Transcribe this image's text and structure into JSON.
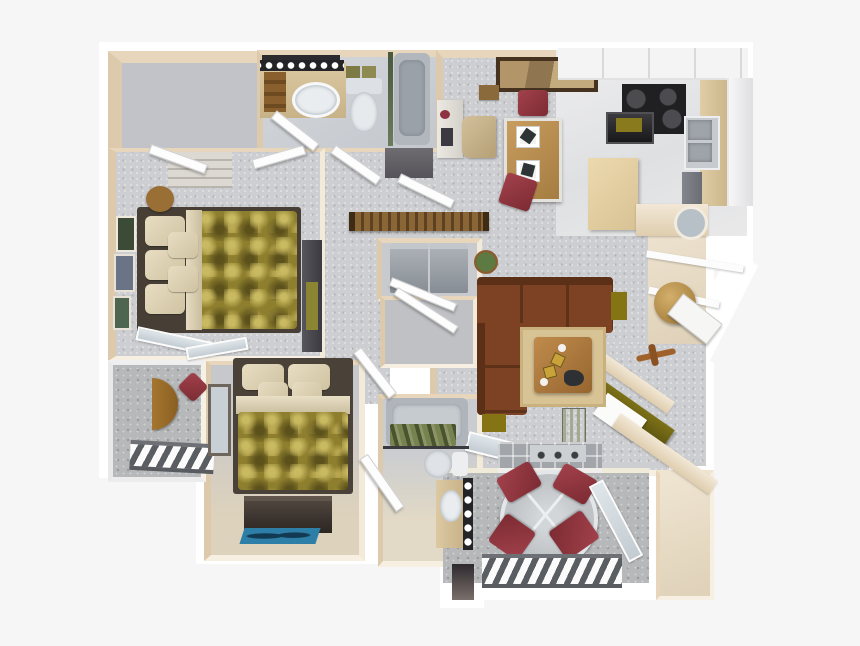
{
  "meta": {
    "description": "3D rendered top-down apartment floor plan, two bedrooms and two bathrooms with balcony and patio",
    "canvas": {
      "width": 860,
      "height": 646
    },
    "background_color": "#f6f6f7"
  },
  "palette": {
    "wall_white": "#ffffff",
    "wall_face_cream": "#e7d6bb",
    "carpet_gray": "#cdced1",
    "carpet_tan": "#d9cfbc",
    "kitchen_floor": "#e8e8ea",
    "concrete_gray": "#b6b8ba",
    "comforter_gold": "#8e7f2e",
    "pillow_cream": "#e0d5b8",
    "sofa_brown": "#71391f",
    "accent_red_chair": "#93333c",
    "wood_table": "#b07c3f",
    "olive_accent": "#6b6013",
    "appliance_gray": "#9ca1a7",
    "porcelain_white": "#e8ecef",
    "counter_tan": "#d8c49c",
    "cabinet_white": "#f4f4f4",
    "stove_black": "#202023",
    "shower_curtain_green": "#6e7a50",
    "rug_blue": "#2e7fa8"
  },
  "rooms": [
    {
      "id": "walk-in-closet",
      "label": "Walk-in closet"
    },
    {
      "id": "master-bathroom",
      "label": "Master bathroom"
    },
    {
      "id": "master-bedroom",
      "label": "Master bedroom"
    },
    {
      "id": "hallway",
      "label": "Hallway"
    },
    {
      "id": "dining-area",
      "label": "Dining area"
    },
    {
      "id": "kitchen",
      "label": "Kitchen"
    },
    {
      "id": "entry",
      "label": "Entry"
    },
    {
      "id": "living-room",
      "label": "Living room"
    },
    {
      "id": "office-nook",
      "label": "Office nook"
    },
    {
      "id": "laundry-closet",
      "label": "Laundry closet"
    },
    {
      "id": "hall-closet",
      "label": "Hall closet"
    },
    {
      "id": "second-bathroom",
      "label": "Second bathroom"
    },
    {
      "id": "second-bedroom",
      "label": "Second bedroom"
    },
    {
      "id": "balcony",
      "label": "Balcony"
    },
    {
      "id": "patio",
      "label": "Patio"
    },
    {
      "id": "storage-closet",
      "label": "Patio storage"
    }
  ],
  "furniture": [
    {
      "id": "master-bed",
      "label": "Queen bed with gold comforter"
    },
    {
      "id": "second-bed",
      "label": "Bed with gold comforter"
    },
    {
      "id": "sectional-sofa",
      "label": "Brown sectional sofa"
    },
    {
      "id": "coffee-table",
      "label": "Square wood coffee table on rug"
    },
    {
      "id": "dining-table",
      "label": "Dining table with two red chairs"
    },
    {
      "id": "kitchen-island",
      "label": "Kitchen island"
    },
    {
      "id": "range",
      "label": "Black range / cooktop"
    },
    {
      "id": "double-sink",
      "label": "Double basin kitchen sink"
    },
    {
      "id": "refrigerator",
      "label": "Refrigerator"
    },
    {
      "id": "washer-dryer",
      "label": "Stacked laundry pair"
    },
    {
      "id": "vanity-1",
      "label": "Master bath vanity with sink and lights"
    },
    {
      "id": "toilet-1",
      "label": "Toilet"
    },
    {
      "id": "bathtub-1",
      "label": "Bathtub with glass screen"
    },
    {
      "id": "bathtub-2",
      "label": "Bathtub with green shower curtain"
    },
    {
      "id": "toilet-2",
      "label": "Toilet"
    },
    {
      "id": "vanity-2",
      "label": "Second bath vanity with sink and lights"
    },
    {
      "id": "fireplace",
      "label": "Fireplace with tiled hearth"
    },
    {
      "id": "patio-set",
      "label": "Round patio table with four red chairs"
    },
    {
      "id": "balcony-set",
      "label": "Half-round balcony table with red chair"
    },
    {
      "id": "dresser",
      "label": "Dark dresser with blue rug"
    },
    {
      "id": "tv-armoire",
      "label": "Media armoire"
    },
    {
      "id": "office-desk",
      "label": "Built-in corner desk"
    },
    {
      "id": "console-table",
      "label": "Slatted wood console table"
    },
    {
      "id": "entry-mirror",
      "label": "Oval entry mirror"
    },
    {
      "id": "wall-painting",
      "label": "Framed painting"
    }
  ]
}
